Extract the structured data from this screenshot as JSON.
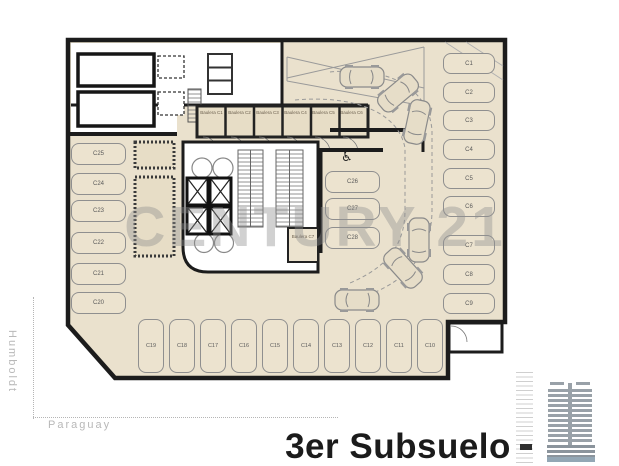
{
  "plan": {
    "title": "3er Subsuelo",
    "watermark": "CENTURY 21",
    "accessible_icon": "♿"
  },
  "streets": {
    "left": "Humboldt",
    "bottom": "Paraguay"
  },
  "parking": {
    "left_column": [
      "C25",
      "C24",
      "C23",
      "C22",
      "C21",
      "C20"
    ],
    "middle_column": [
      "C26",
      "C27",
      "C28"
    ],
    "right_column": [
      "C1",
      "C2",
      "C3",
      "C4",
      "C5",
      "C6",
      "C7",
      "C8",
      "C9"
    ],
    "bottom_row": [
      "C19",
      "C18",
      "C17",
      "C16",
      "C15",
      "C14",
      "C13",
      "C12",
      "C11",
      "C10"
    ]
  },
  "storage": {
    "top_row": [
      "Baulera C1",
      "Baulera C2",
      "Baulera C3",
      "Baulera C4",
      "Baulera C5",
      "Baulera C6"
    ],
    "core_room": "Baulera C7"
  },
  "colors": {
    "floor": "#eae1cd",
    "wall": "#1c1c1c",
    "stall_outline": "#8f8f8f",
    "watermark": "#8f8f8f",
    "street_label": "#b8b8b8",
    "title_text": "#1b1b1b",
    "building_icon": "#99a1a8",
    "building_base_highlight": "#93a7b5"
  }
}
